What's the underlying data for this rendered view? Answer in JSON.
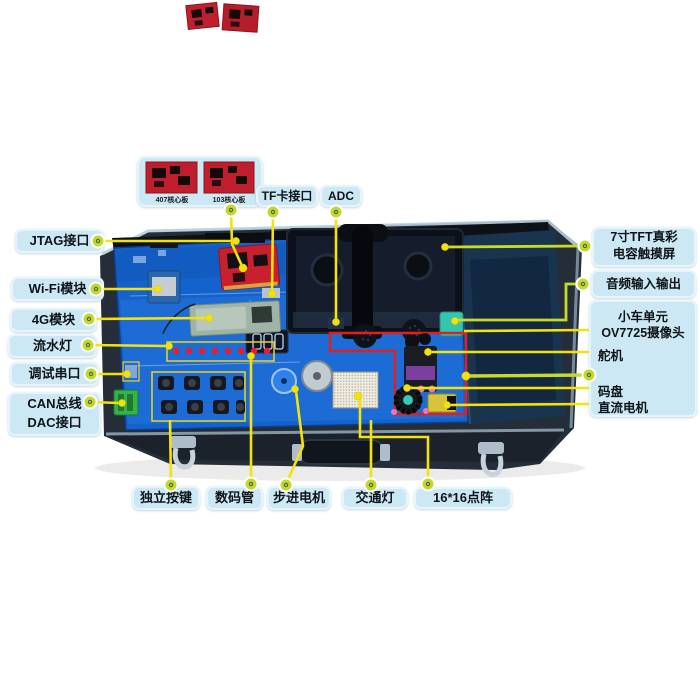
{
  "title": "嵌入式开发平台部件标注图",
  "palette": {
    "label_bg": "#cbe8f4",
    "line_yellow": "#f4e20c",
    "line_lime": "#c6da2e",
    "dot_green": "#c3d82e",
    "red_outline": "#e02020",
    "pcb_blue": "#1463cc",
    "case_dark": "#242d38",
    "core_board_red": "#c0202e"
  },
  "inset": {
    "captions": [
      "407核心板",
      "103核心板"
    ]
  },
  "labels": {
    "jtag": {
      "text": "JTAG接口"
    },
    "wifi": {
      "text": "Wi-Fi模块"
    },
    "g4": {
      "text": "4G模块"
    },
    "led_chaser": {
      "text": "流水灯"
    },
    "debug_uart": {
      "text": "调试串口"
    },
    "can_dac": {
      "line1": "CAN总线",
      "line2": "DAC接口"
    },
    "tf_card": {
      "text": "TF卡接口"
    },
    "adc": {
      "text": "ADC"
    },
    "tft": {
      "line1": "7寸TFT真彩",
      "line2": "电容触摸屏"
    },
    "audio": {
      "text": "音频输入输出"
    },
    "car_unit": {
      "title": "小车单元",
      "camera": "OV7725摄像头",
      "servo": "舵机",
      "encoder": "码盘",
      "dc_motor": "直流电机"
    },
    "keys": {
      "text": "独立按键"
    },
    "seven_seg": {
      "text": "数码管"
    },
    "stepper": {
      "text": "步进电机"
    },
    "traffic": {
      "text": "交通灯"
    },
    "dot_matrix": {
      "text": "16*16点阵"
    }
  }
}
